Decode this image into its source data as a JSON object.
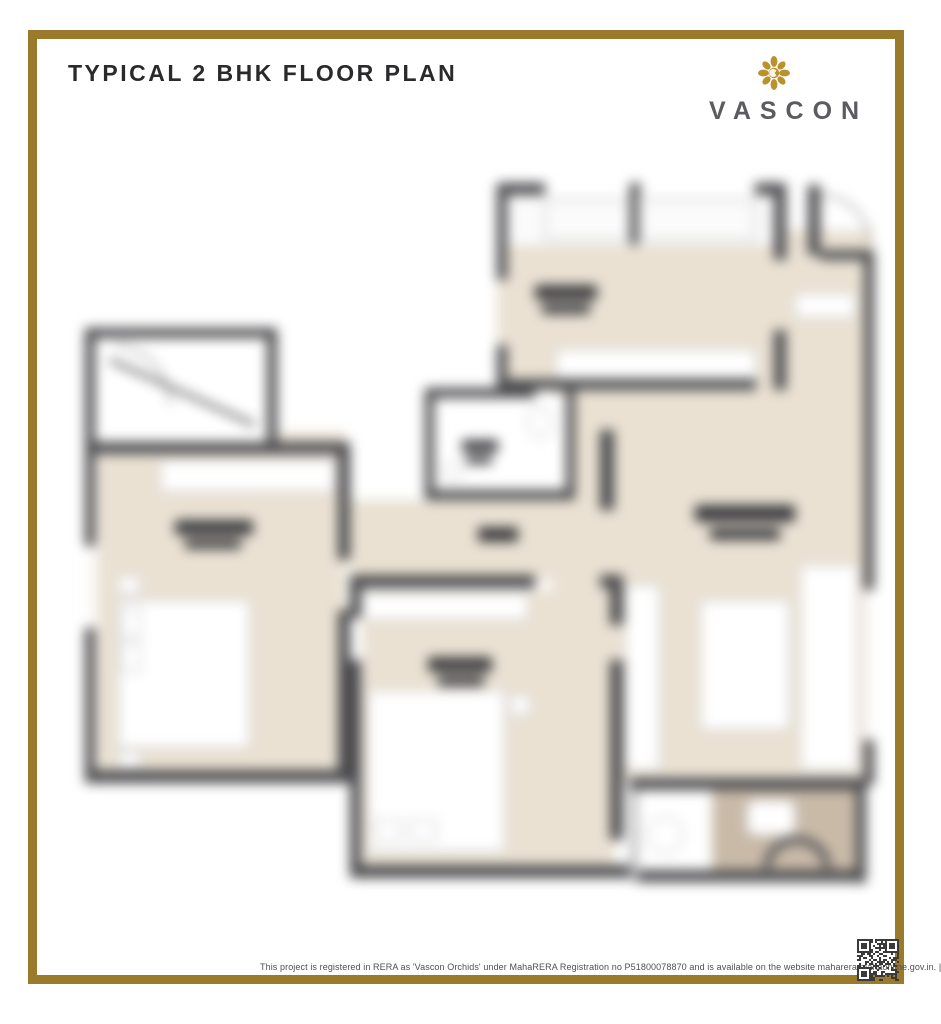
{
  "header": {
    "title": "TYPICAL 2 BHK FLOOR PLAN"
  },
  "brand": {
    "name": "VASCON",
    "icon": "vascon-flower-icon"
  },
  "footer": {
    "disclaimer": "This project is registered in RERA as 'Vascon Orchids' under MahaRERA Registration no P51800078870 and is available on the website maharera.mahaonline.gov.in. | *T&C apply"
  },
  "floor_plan": {
    "type": "2 BHK",
    "appearance": "blurred architectural floor plan render",
    "rooms_visible_as_shapes": [
      "entrance-foyer",
      "master-bedroom",
      "second-bedroom",
      "kitchen",
      "living-dining",
      "toilet",
      "bathroom"
    ]
  },
  "colors": {
    "frame_gold": "#9c7a2b",
    "brand_gold": "#b9922e",
    "title": "#2a2a2c",
    "brand_text": "#5b5c60",
    "disclaimer": "#4f4f4f",
    "wall": "#4a4a4d",
    "floor": "#eae1d3",
    "bath_floor": "#c9baa8"
  }
}
